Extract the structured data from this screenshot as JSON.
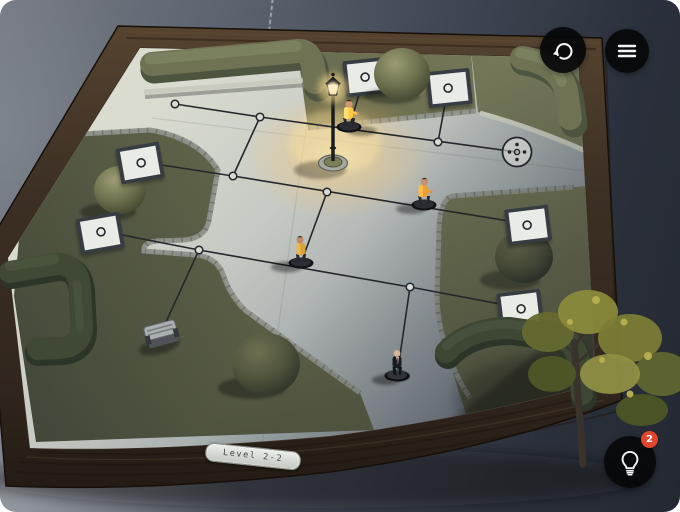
{
  "hud": {
    "restart_button": {
      "icon": "restart-icon"
    },
    "menu_button": {
      "icon": "menu-icon"
    },
    "hint_button": {
      "icon": "lightbulb-icon",
      "badge": "2"
    },
    "level_plaque": {
      "label": "Level 2-2"
    }
  },
  "board": {
    "player": {
      "name": "Agent 47",
      "suit": "black",
      "tie": "red"
    },
    "enemies": [
      {
        "type": "guard",
        "jacket": "yellow",
        "location": "top path beside street lamp"
      },
      {
        "type": "guard",
        "jacket": "yellow",
        "location": "right path near right garden"
      },
      {
        "type": "guard",
        "jacket": "yellow",
        "location": "center path"
      }
    ],
    "exit": "dotted-circle-node",
    "card_tiles": 6,
    "objects": [
      "street-lamp",
      "bench",
      "round-bushes",
      "hedges",
      "tree"
    ]
  },
  "colors": {
    "background": "#3a414c",
    "wood_frame": "#3b2f25",
    "grass": "#6d7153",
    "path_concrete": "#c7cbc5",
    "enemy_yellow": "#f3a93a",
    "lamp_glow": "#ffd584",
    "badge_red": "#e2452e",
    "button_black": "#0b0c0e",
    "plaque_silver": "#d9dcd7",
    "line_dark": "#24272c"
  }
}
